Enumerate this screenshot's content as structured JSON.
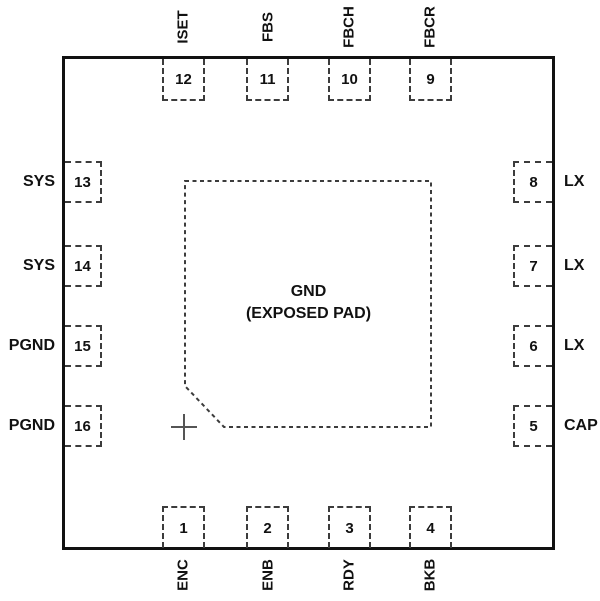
{
  "figure": {
    "type": "ic-pinout",
    "package_center_pad": {
      "line1": "GND",
      "line2": "(EXPOSED PAD)"
    },
    "pins": {
      "top": [
        {
          "number": "12",
          "name": "ISET"
        },
        {
          "number": "11",
          "name": "FBS"
        },
        {
          "number": "10",
          "name": "FBCH"
        },
        {
          "number": "9",
          "name": "FBCR"
        }
      ],
      "right": [
        {
          "number": "8",
          "name": "LX"
        },
        {
          "number": "7",
          "name": "LX"
        },
        {
          "number": "6",
          "name": "LX"
        },
        {
          "number": "5",
          "name": "CAP"
        }
      ],
      "bottom": [
        {
          "number": "1",
          "name": "ENC"
        },
        {
          "number": "2",
          "name": "ENB"
        },
        {
          "number": "3",
          "name": "RDY"
        },
        {
          "number": "4",
          "name": "BKB"
        }
      ],
      "left": [
        {
          "number": "13",
          "name": "SYS"
        },
        {
          "number": "14",
          "name": "SYS"
        },
        {
          "number": "15",
          "name": "PGND"
        },
        {
          "number": "16",
          "name": "PGND"
        }
      ]
    },
    "colors": {
      "outline": "#111111",
      "dashed": "#3c3c3c",
      "text": "#111111",
      "background": "#ffffff"
    }
  }
}
